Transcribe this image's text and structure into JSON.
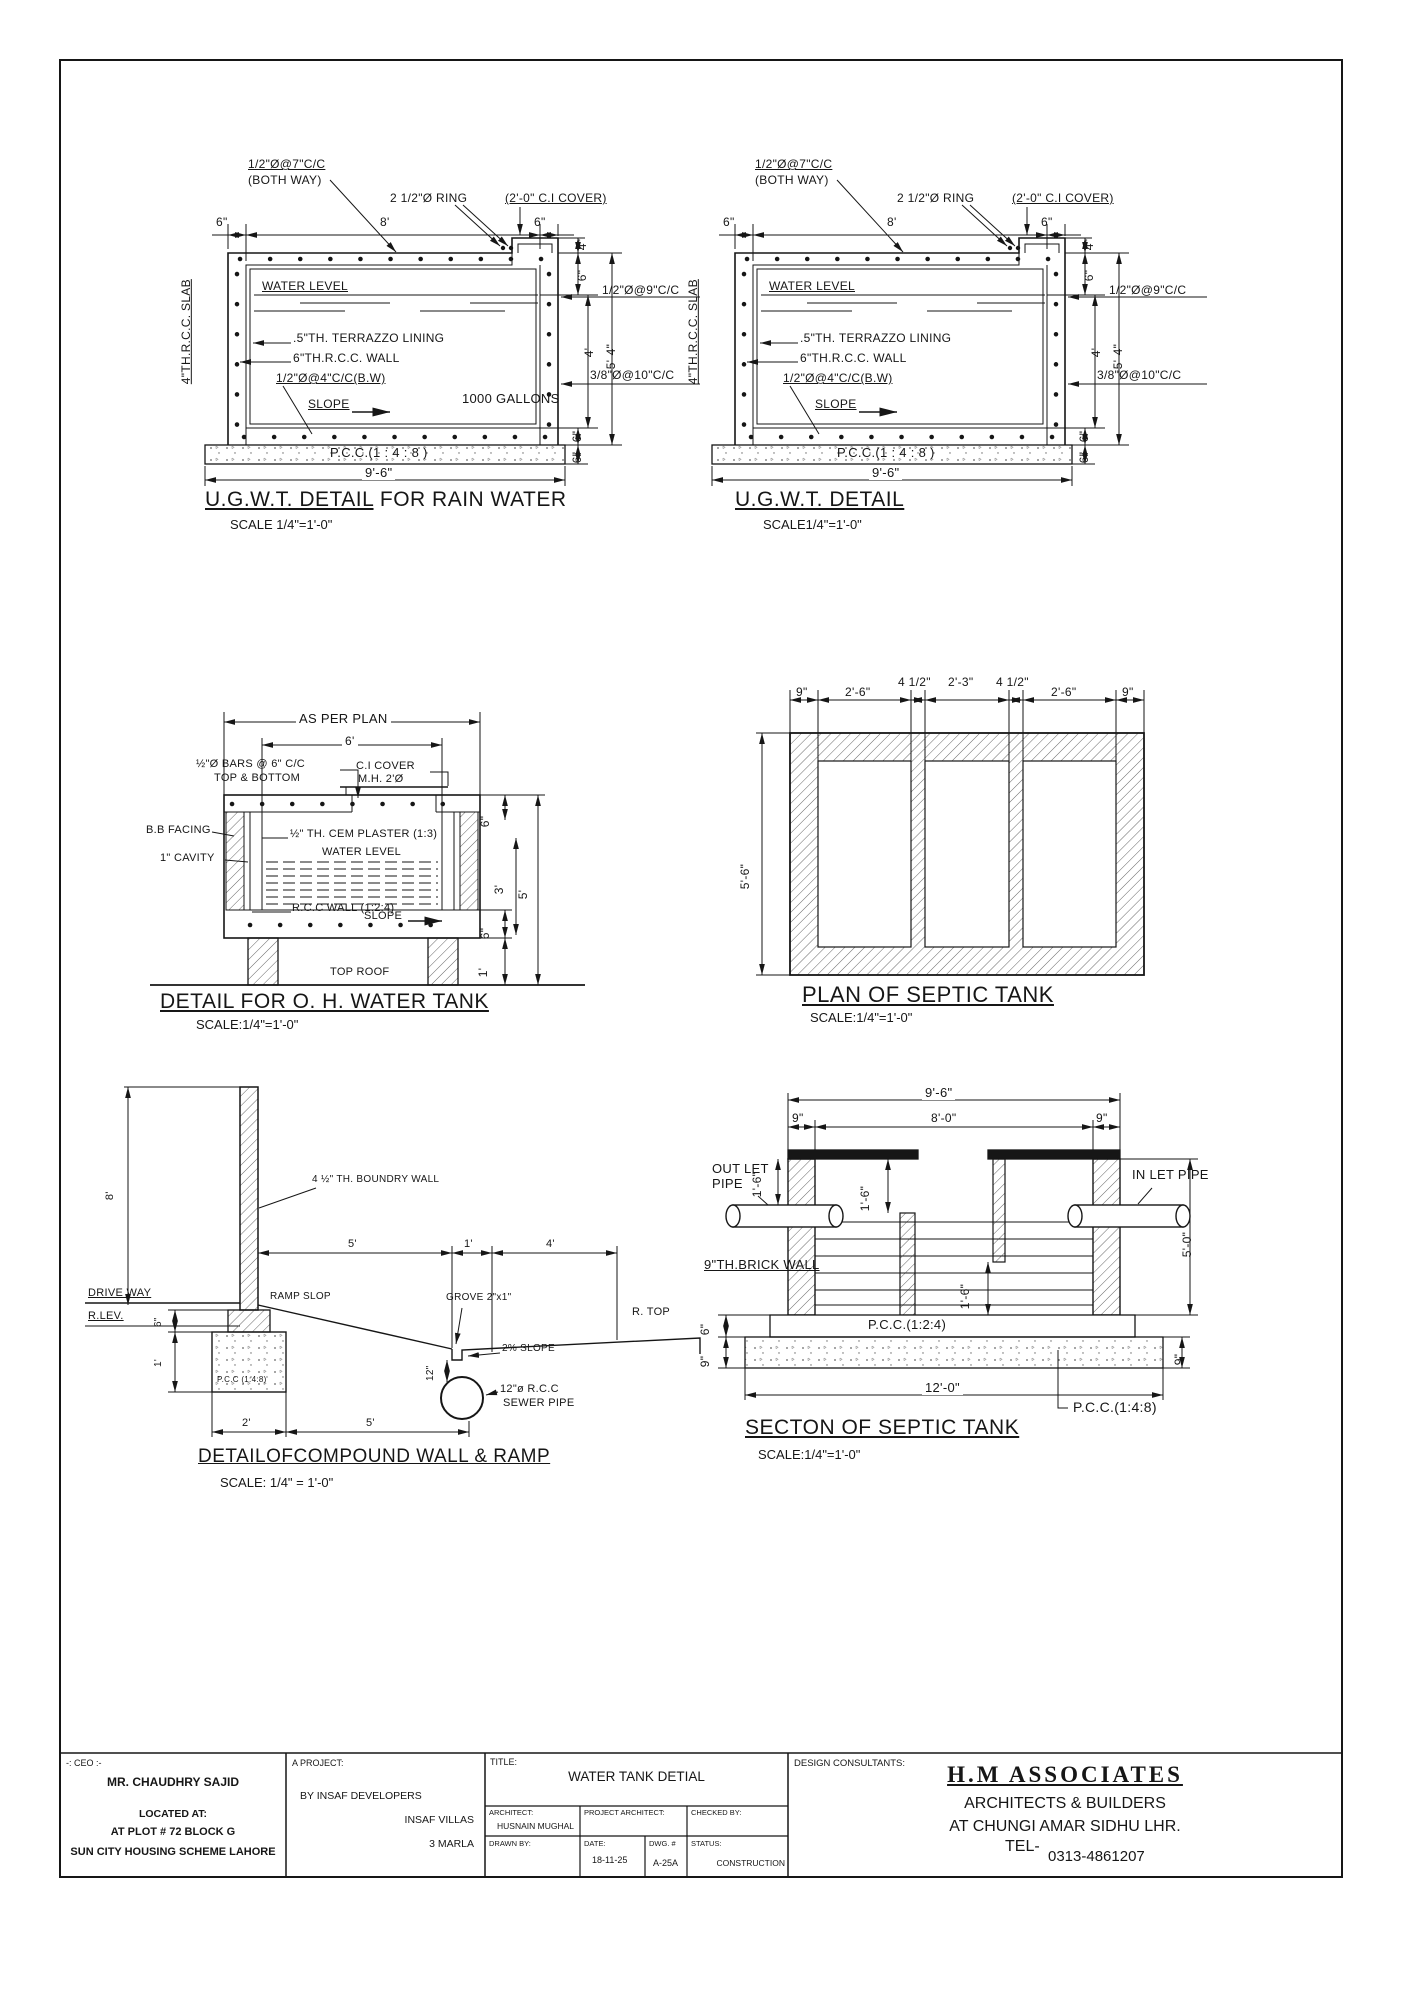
{
  "ugwt_rain": {
    "title_main": "U.G.W.T. DETAIL",
    "title_suffix": " FOR RAIN WATER",
    "scale": "SCALE 1/4\"=1'-0\"",
    "top_bars": "1/2\"Ø@7\"C/C",
    "both_way": "(BOTH WAY)",
    "ring": "2 1/2\"Ø RING",
    "cover": "(2'-0\" C.I COVER)",
    "water_level": "WATER LEVEL",
    "terrazzo": ".5\"TH. TERRAZZO LINING",
    "wall": "6\"TH.R.C.C. WALL",
    "bw_bars": "1/2\"Ø@4\"C/C(B.W)",
    "slope": "SLOPE",
    "gallons": "1000 GALLONS",
    "pcc": "P.C.C.(1 : 4 : 8 )",
    "slab": "4\"TH.R.C.C. SLAB",
    "side_bars": "1/2\"Ø@9\"C/C",
    "bottom_bars": "3/8\"Ø@10\"C/C",
    "dims": {
      "d6l": "6\"",
      "d8": "8'",
      "d6r": "6\"",
      "r4": "4\"",
      "r6": "6\"",
      "h4": "4'",
      "h54": "5'-4\"",
      "b6a": "6\"",
      "b6b": "6\"",
      "w96": "9'-6\""
    }
  },
  "ugwt": {
    "title_main": "U.G.W.T. DETAIL",
    "scale": "SCALE1/4\"=1'-0\"",
    "top_bars": "1/2\"Ø@7\"C/C",
    "both_way": "(BOTH WAY)",
    "ring": "2 1/2\"Ø RING",
    "cover": "(2'-0\" C.I COVER)",
    "water_level": "WATER LEVEL",
    "terrazzo": ".5\"TH. TERRAZZO LINING",
    "wall": "6\"TH.R.C.C. WALL",
    "bw_bars": "1/2\"Ø@4\"C/C(B.W)",
    "slope": "SLOPE",
    "pcc": "P.C.C.(1 : 4 : 8 )",
    "slab": "4\"TH.R.C.C. SLAB",
    "side_bars": "1/2\"Ø@9\"C/C",
    "bottom_bars": "3/8\"Ø@10\"C/C",
    "dims": {
      "d6l": "6\"",
      "d8": "8'",
      "d6r": "6\"",
      "r4": "4\"",
      "r6": "6\"",
      "h4": "4'",
      "h54": "5'-4\"",
      "b6a": "6\"",
      "b6b": "6\"",
      "w96": "9'-6\""
    }
  },
  "oh_tank": {
    "title": "DETAIL FOR O. H. WATER TANK",
    "scale": "SCALE:1/4\"=1'-0\"",
    "as_per_plan": "AS PER PLAN",
    "d6": "6'",
    "bars1": "½\"Ø BARS @ 6\" C/C",
    "bars2": "TOP & BOTTOM",
    "ci1": "C.I COVER",
    "ci2": "M.H. 2'Ø",
    "bb_facing": "B.B FACING",
    "cavity": "1\" CAVITY",
    "plaster": "½\" TH. CEM PLASTER (1:3)",
    "water_level": "WATER LEVEL",
    "rcc_wall": "R.C.C WALL (1:2:4)",
    "slope": "SLOPE",
    "top_roof": "TOP ROOF",
    "dims": {
      "r6a": "6\"",
      "r3": "3'",
      "r5": "5'",
      "r6b": "6\"",
      "r1": "1'"
    }
  },
  "septic_plan": {
    "title": "PLAN OF SEPTIC TANK",
    "scale": "SCALE:1/4\"=1'-0\"",
    "dims": {
      "d9a": "9\"",
      "d26a": "2'-6\"",
      "d45a": "4 1/2\"",
      "d23": "2'-3\"",
      "d45b": "4 1/2\"",
      "d26b": "2'-6\"",
      "d9b": "9\"",
      "d56": "5'-6\""
    }
  },
  "septic_section": {
    "title": "SECTON OF SEPTIC TANK",
    "scale": "SCALE:1/4\"=1'-0\"",
    "outlet1": "OUT LET",
    "outlet2": "PIPE",
    "inlet": "IN LET PIPE",
    "brick_wall": "9\"TH.BRICK WALL",
    "pcc124": "P.C.C.(1:2:4)",
    "pcc148": "P.C.C.(1:4:8)",
    "dims": {
      "d96": "9'-6\"",
      "d9a": "9\"",
      "d80": "8'-0\"",
      "d9b": "9\"",
      "r16a": "1'-6\"",
      "r16b": "1'-6\"",
      "r16c": "1'-6\"",
      "r50": "5'-0\"",
      "r6": "6\"",
      "r9a": "9\"",
      "r9b": "9\"",
      "d120": "12'-0\""
    }
  },
  "compound": {
    "title": "DETAILOFCOMPOUND WALL & RAMP",
    "scale": "SCALE: 1/4\" = 1'-0\"",
    "wall_label": "4 ½\" TH. BOUNDRY WALL",
    "drive_way": "DRIVE WAY",
    "r_lev": "R.LEV.",
    "ramp_slop": "RAMP SLOP",
    "grove": "GROVE 2\"x1\"",
    "slope2": "2% SLOPE",
    "r_top": "R. TOP",
    "sewer1": "12\"ø R.C.C",
    "sewer2": "SEWER PIPE",
    "pcc": "P.C.C (1:4:8)",
    "dims": {
      "d8": "8'",
      "d5": "5'",
      "d1": "1'",
      "d4": "4'",
      "r6": "6\"",
      "r1": "1'",
      "r12": "12\"",
      "b2": "2'",
      "b5": "5'"
    }
  },
  "title_block": {
    "ceo_label": "-: CEO :-",
    "ceo_name": "MR. CHAUDHRY SAJID",
    "located": "LOCATED AT:",
    "plot": "AT PLOT # 72 BLOCK G",
    "scheme": "SUN CITY HOUSING SCHEME LAHORE",
    "project_label": "A PROJECT:",
    "developer": "BY INSAF DEVELOPERS",
    "villas": "INSAF VILLAS",
    "marla": "3 MARLA",
    "title_label": "TITLE:",
    "drawing_title": "WATER TANK DETIAL",
    "architect_label": "ARCHITECT:",
    "architect": "HUSNAIN MUGHAL",
    "project_architect_label": "PROJECT ARCHITECT:",
    "checked_label": "CHECKED BY:",
    "drawn_label": "DRAWN BY:",
    "date_label": "DATE:",
    "date": "18-11-25",
    "dwg_label": "DWG. #",
    "dwg": "A-25A",
    "status_label": "STATUS:",
    "status": "CONSTRUCTION",
    "consultants_label": "DESIGN CONSULTANTS:",
    "firm": "H.M  ASSOCIATES",
    "firm2": "ARCHITECTS & BUILDERS",
    "firm3": "AT CHUNGI AMAR SIDHU LHR.",
    "tel_label": "TEL-",
    "tel": "0313-4861207"
  }
}
